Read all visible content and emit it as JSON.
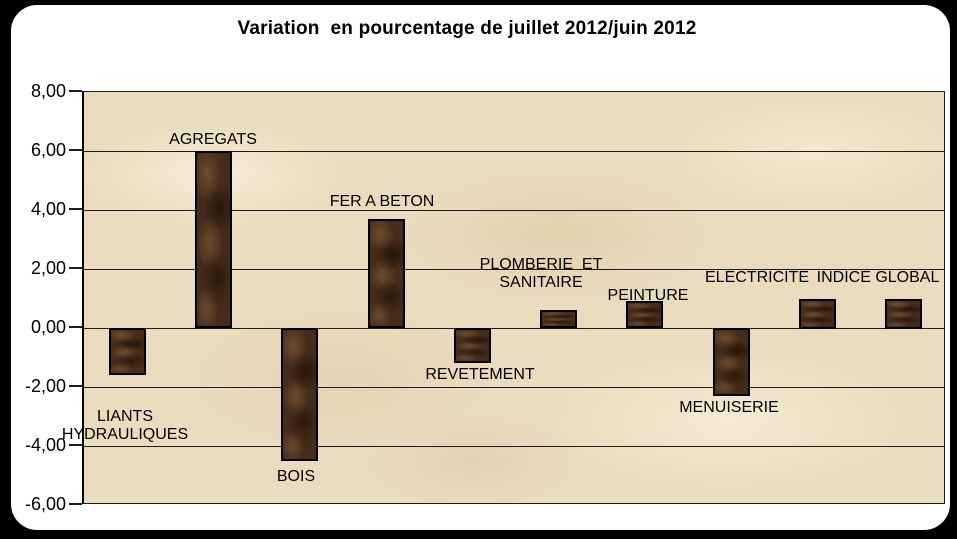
{
  "window": {
    "page_background": "#000000",
    "card_background": "#ffffff"
  },
  "chart_data": {
    "type": "bar",
    "title": "Variation  en pourcentage de juillet 2012/juin 2012",
    "categories": [
      "LIANTS HYDRAULIQUES",
      "AGREGATS",
      "BOIS",
      "FER A BETON",
      "REVETEMENT",
      "PLOMBERIE ET SANITAIRE",
      "PEINTURE",
      "MENUISERIE",
      "ELECTRICITE",
      "INDICE GLOBAL"
    ],
    "values": [
      -1.6,
      6.0,
      -4.5,
      3.7,
      -1.2,
      0.6,
      0.9,
      -2.3,
      1.0,
      1.0
    ],
    "xlabel": "",
    "ylabel": "",
    "ylim": [
      -6,
      8
    ],
    "ytick_step": 2,
    "yticks": [
      {
        "value": 8,
        "label": "8,00"
      },
      {
        "value": 6,
        "label": "6,00"
      },
      {
        "value": 4,
        "label": "4,00"
      },
      {
        "value": 2,
        "label": "2,00"
      },
      {
        "value": 0,
        "label": "0,00"
      },
      {
        "value": -2,
        "label": "-2,00"
      },
      {
        "value": -4,
        "label": "-4,00"
      },
      {
        "value": -6,
        "label": "-6,00"
      }
    ],
    "grid": true,
    "legend": false,
    "decimal_separator": ",",
    "colors": {
      "bar": "#452c1a",
      "bar_border": "#000000",
      "plot_background": "#e9dcbe",
      "grid_line": "#1d1d1d",
      "text": "#000000"
    },
    "label_layout": [
      {
        "lines": [
          "LIANTS",
          "HYDRAULIQUES"
        ],
        "cx": 125,
        "top": 408
      },
      {
        "lines": [
          "AGREGATS"
        ],
        "cx": 213,
        "top": 131
      },
      {
        "lines": [
          "BOIS"
        ],
        "cx": 296,
        "top": 468
      },
      {
        "lines": [
          "FER A BETON"
        ],
        "cx": 382,
        "top": 193
      },
      {
        "lines": [
          "REVETEMENT"
        ],
        "cx": 480,
        "top": 366
      },
      {
        "lines": [
          "PLOMBERIE  ET",
          "SANITAIRE"
        ],
        "cx": 541,
        "top": 256
      },
      {
        "lines": [
          "PEINTURE"
        ],
        "cx": 648,
        "top": 287
      },
      {
        "lines": [
          "MENUISERIE"
        ],
        "cx": 729,
        "top": 399
      },
      {
        "lines": [
          "ELECTRICITE"
        ],
        "cx": 757,
        "top": 269
      },
      {
        "lines": [
          "INDICE GLOBAL"
        ],
        "cx": 878,
        "top": 269
      }
    ]
  }
}
